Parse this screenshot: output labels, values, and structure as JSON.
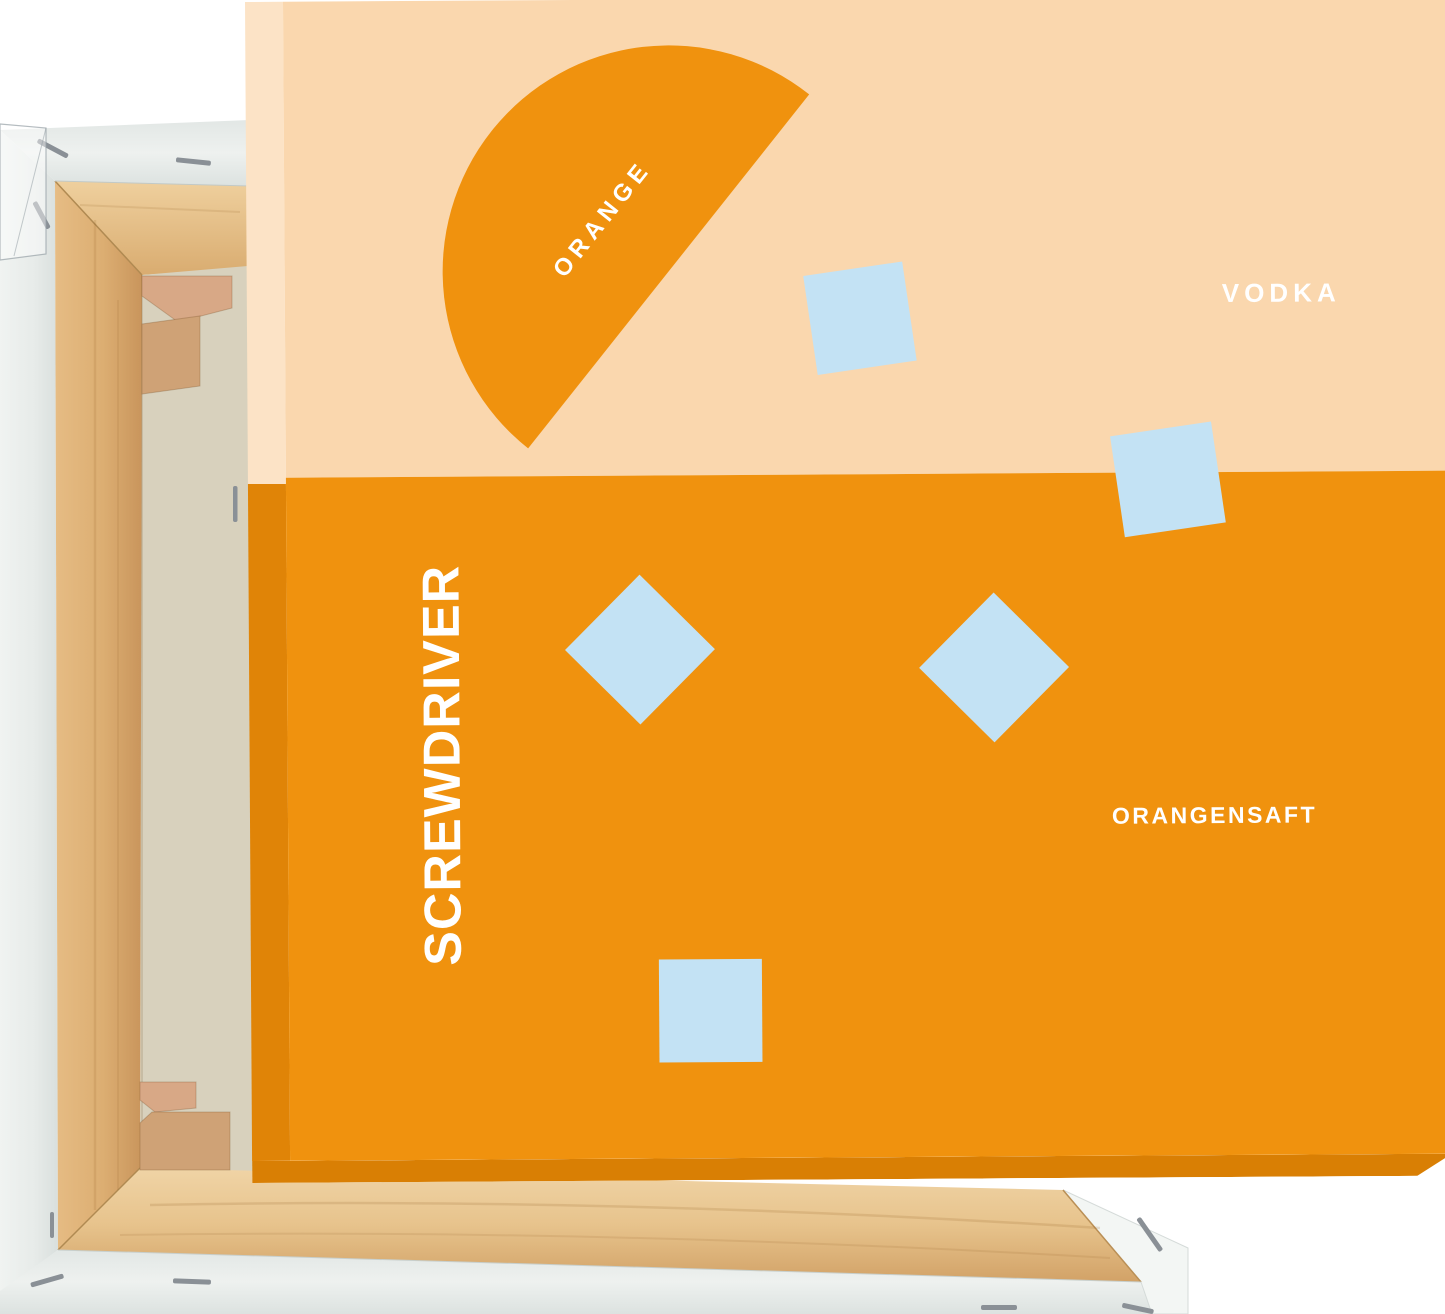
{
  "artwork": {
    "semicircle_label": "ORANGE",
    "vodka_label": "VODKA",
    "title_vertical": "SCREWDRIVER",
    "juice_label": "ORANGENSAFT"
  },
  "palette": {
    "peach": "#FAD7AE",
    "peach_side": "#FCE3C6",
    "orange": "#F0920E",
    "orange_side": "#E08407",
    "orange_edge": "#D97F04",
    "ice_blue": "#C3E2F4",
    "text_white": "#FFFFFF",
    "wood_light": "#EDCC98",
    "wood_mid": "#DFB278",
    "wood_dark": "#C9955C",
    "wood_key_pink": "#D8A886",
    "wood_key_tan": "#CFA276",
    "canvas_raw": "#D8D1BD",
    "wrap_white": "#EAEEEC",
    "wrap_shade": "#D9DFDD",
    "wrap_bright": "#F3F6F4",
    "staple_gray": "#8A9096"
  }
}
